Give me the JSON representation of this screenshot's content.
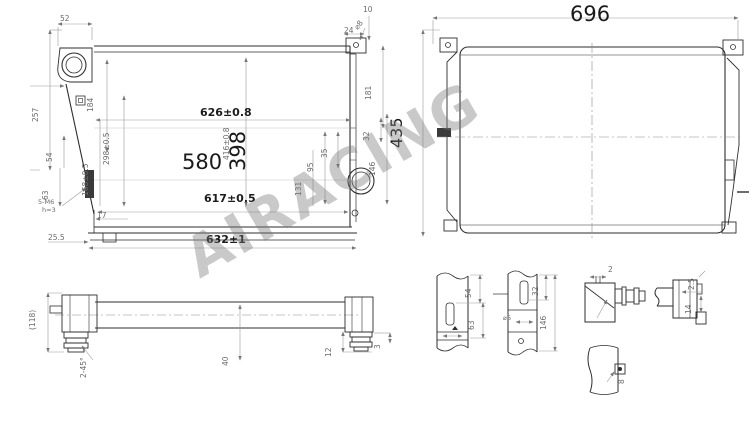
{
  "watermark": {
    "text": "AIRACING"
  },
  "front_view": {
    "d52": "52",
    "d257": "257",
    "d184": "184",
    "d24": "24",
    "phi8": "⌀8",
    "d10": "10",
    "d181": "181",
    "d626": "626±0.8",
    "d416": "416±0.8",
    "d398": "398",
    "d580": "580",
    "d298": "298±0.5",
    "d168": "168±0.5",
    "d54": "54",
    "d63": "63",
    "m6": "5-M6",
    "h3": "h=3",
    "d255": "25.5",
    "d17": "17",
    "d617": "617±0.5",
    "d632": "632±1",
    "d95": "95",
    "d35": "35",
    "d131": "131",
    "d32": "32",
    "d146": "146"
  },
  "rear_view": {
    "d696": "696",
    "d435": "435"
  },
  "side_view": {
    "d118": "(118)",
    "chamfer": "2-45°",
    "d40": "40",
    "d12": "12",
    "d3": "3"
  },
  "section_a": {
    "d54": "54",
    "d63": "63"
  },
  "section_b": {
    "d32": "32",
    "d146": "146",
    "phi": "⌀6"
  },
  "detail_c": {
    "d2": "2"
  },
  "detail_d": {
    "d25": "2.5",
    "d14": "14"
  },
  "detail_e": {
    "d8": "8"
  }
}
